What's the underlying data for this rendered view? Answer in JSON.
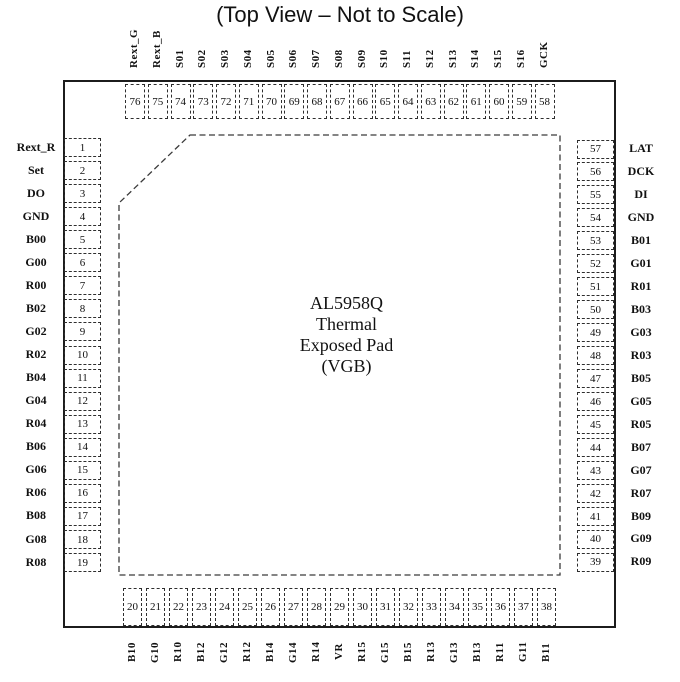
{
  "title": "(Top View – Not to Scale)",
  "chip_label": {
    "lines": [
      "AL5958Q",
      "Thermal",
      "Exposed Pad",
      "(VGB)"
    ]
  },
  "pins": {
    "top": [
      {
        "num": "76",
        "label": "Rext_G"
      },
      {
        "num": "75",
        "label": "Rext_B"
      },
      {
        "num": "74",
        "label": "S01"
      },
      {
        "num": "73",
        "label": "S02"
      },
      {
        "num": "72",
        "label": "S03"
      },
      {
        "num": "71",
        "label": "S04"
      },
      {
        "num": "70",
        "label": "S05"
      },
      {
        "num": "69",
        "label": "S06"
      },
      {
        "num": "68",
        "label": "S07"
      },
      {
        "num": "67",
        "label": "S08"
      },
      {
        "num": "66",
        "label": "S09"
      },
      {
        "num": "65",
        "label": "S10"
      },
      {
        "num": "64",
        "label": "S11"
      },
      {
        "num": "63",
        "label": "S12"
      },
      {
        "num": "62",
        "label": "S13"
      },
      {
        "num": "61",
        "label": "S14"
      },
      {
        "num": "60",
        "label": "S15"
      },
      {
        "num": "59",
        "label": "S16"
      },
      {
        "num": "58",
        "label": "GCK"
      }
    ],
    "left": [
      {
        "num": "1",
        "label": "Rext_R"
      },
      {
        "num": "2",
        "label": "Set"
      },
      {
        "num": "3",
        "label": "DO"
      },
      {
        "num": "4",
        "label": "GND"
      },
      {
        "num": "5",
        "label": "B00"
      },
      {
        "num": "6",
        "label": "G00"
      },
      {
        "num": "7",
        "label": "R00"
      },
      {
        "num": "8",
        "label": "B02"
      },
      {
        "num": "9",
        "label": "G02"
      },
      {
        "num": "10",
        "label": "R02"
      },
      {
        "num": "11",
        "label": "B04"
      },
      {
        "num": "12",
        "label": "G04"
      },
      {
        "num": "13",
        "label": "R04"
      },
      {
        "num": "14",
        "label": "B06"
      },
      {
        "num": "15",
        "label": "G06"
      },
      {
        "num": "16",
        "label": "R06"
      },
      {
        "num": "17",
        "label": "B08"
      },
      {
        "num": "18",
        "label": "G08"
      },
      {
        "num": "19",
        "label": "R08"
      }
    ],
    "right": [
      {
        "num": "57",
        "label": "LAT"
      },
      {
        "num": "56",
        "label": "DCK"
      },
      {
        "num": "55",
        "label": "DI"
      },
      {
        "num": "54",
        "label": "GND"
      },
      {
        "num": "53",
        "label": "B01"
      },
      {
        "num": "52",
        "label": "G01"
      },
      {
        "num": "51",
        "label": "R01"
      },
      {
        "num": "50",
        "label": "B03"
      },
      {
        "num": "49",
        "label": "G03"
      },
      {
        "num": "48",
        "label": "R03"
      },
      {
        "num": "47",
        "label": "B05"
      },
      {
        "num": "46",
        "label": "G05"
      },
      {
        "num": "45",
        "label": "R05"
      },
      {
        "num": "44",
        "label": "B07"
      },
      {
        "num": "43",
        "label": "G07"
      },
      {
        "num": "42",
        "label": "R07"
      },
      {
        "num": "41",
        "label": "B09"
      },
      {
        "num": "40",
        "label": "G09"
      },
      {
        "num": "39",
        "label": "R09"
      }
    ],
    "bottom": [
      {
        "num": "20",
        "label": "B10"
      },
      {
        "num": "21",
        "label": "G10"
      },
      {
        "num": "22",
        "label": "R10"
      },
      {
        "num": "23",
        "label": "B12"
      },
      {
        "num": "24",
        "label": "G12"
      },
      {
        "num": "25",
        "label": "R12"
      },
      {
        "num": "26",
        "label": "B14"
      },
      {
        "num": "27",
        "label": "G14"
      },
      {
        "num": "28",
        "label": "R14"
      },
      {
        "num": "29",
        "label": "VR"
      },
      {
        "num": "30",
        "label": "R15"
      },
      {
        "num": "31",
        "label": "G15"
      },
      {
        "num": "32",
        "label": "B15"
      },
      {
        "num": "33",
        "label": "R13"
      },
      {
        "num": "34",
        "label": "G13"
      },
      {
        "num": "35",
        "label": "B13"
      },
      {
        "num": "36",
        "label": "R11"
      },
      {
        "num": "37",
        "label": "G11"
      },
      {
        "num": "38",
        "label": "B11"
      }
    ]
  },
  "colors": {
    "background": "#ffffff",
    "line": "#1c1c1c",
    "dashed_line": "#2e2e2e",
    "text": "#111111"
  }
}
